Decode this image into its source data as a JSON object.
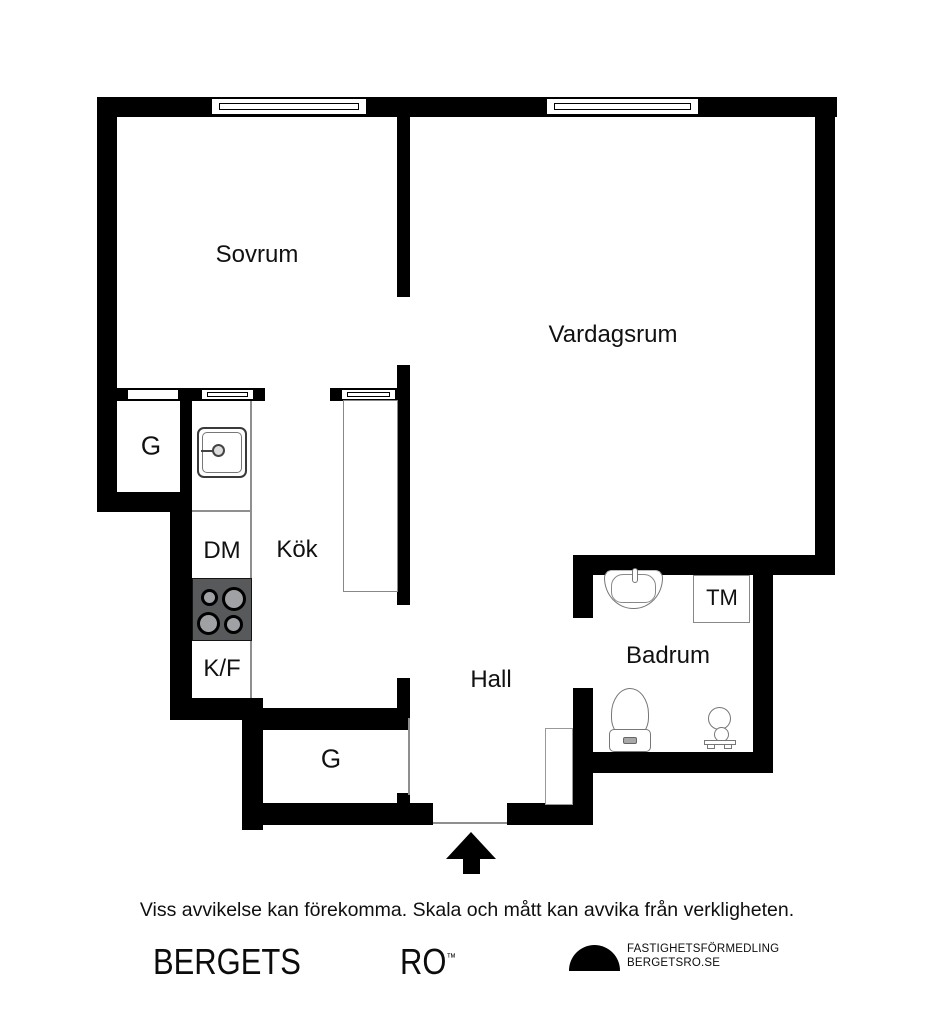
{
  "plan": {
    "rooms": {
      "sovrum": "Sovrum",
      "vardagsrum": "Vardagsrum",
      "kok": "Kök",
      "hall": "Hall",
      "badrum": "Badrum"
    },
    "fixtures": {
      "closet_upper": "G",
      "closet_lower": "G",
      "dishwasher": "DM",
      "fridge_freezer": "K/F",
      "washing_machine": "TM"
    },
    "icons": {
      "entrance_arrow": "up-arrow-entrance-marker",
      "windows": "double-line-window-symbol"
    }
  },
  "footer": {
    "disclaimer": "Viss avvikelse kan förekomma. Skala och mått kan avvika från verkligheten.",
    "brand": {
      "word1": "BERGETS",
      "word2": "RO",
      "trademark": "™"
    },
    "agency": {
      "line1": "FASTIGHETSFÖRMEDLING",
      "line2": "BERGETSRO.SE"
    }
  },
  "colors": {
    "wall": "#000000",
    "stove_body": "#58595B",
    "burner": "#9FA1A4",
    "thin_line": "#8f8f8f",
    "background": "#ffffff"
  }
}
